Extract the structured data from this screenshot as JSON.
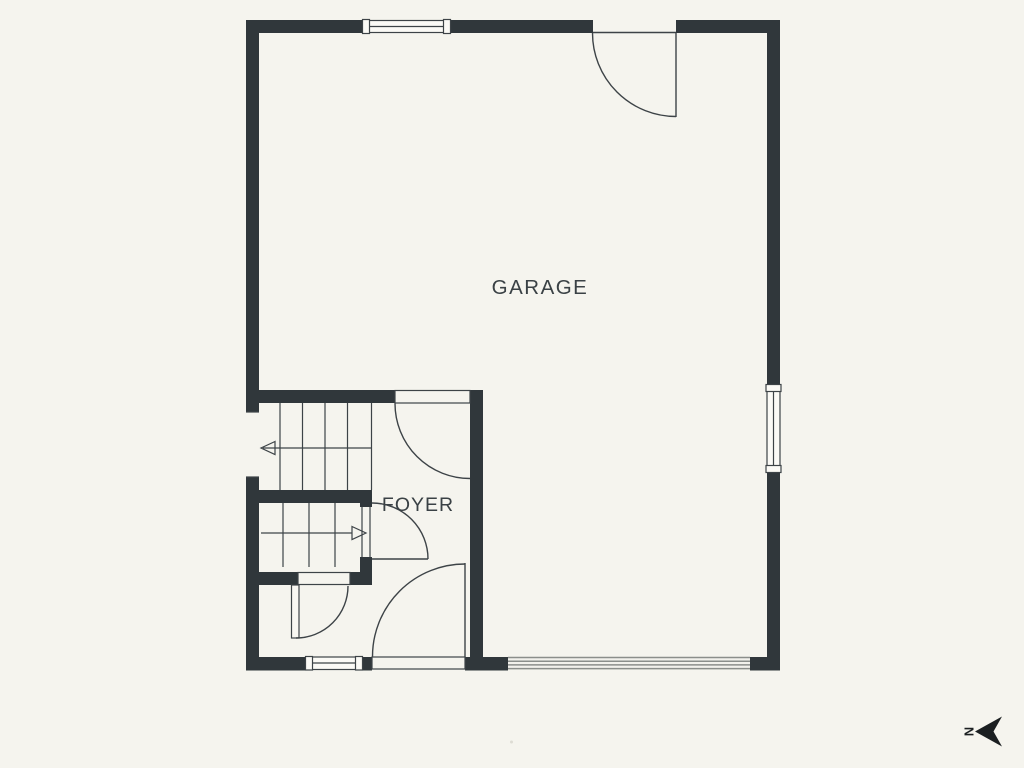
{
  "colors": {
    "background": "#f5f4ee",
    "wall": "#30373b",
    "line": "#3d4347",
    "slat": "#8b8e8b",
    "text": "#3a4145",
    "compass": "#1b1f21"
  },
  "rooms": {
    "garage": {
      "label": "GARAGE"
    },
    "foyer": {
      "label": "FOYER"
    }
  },
  "compass": {
    "north_label": "N"
  }
}
